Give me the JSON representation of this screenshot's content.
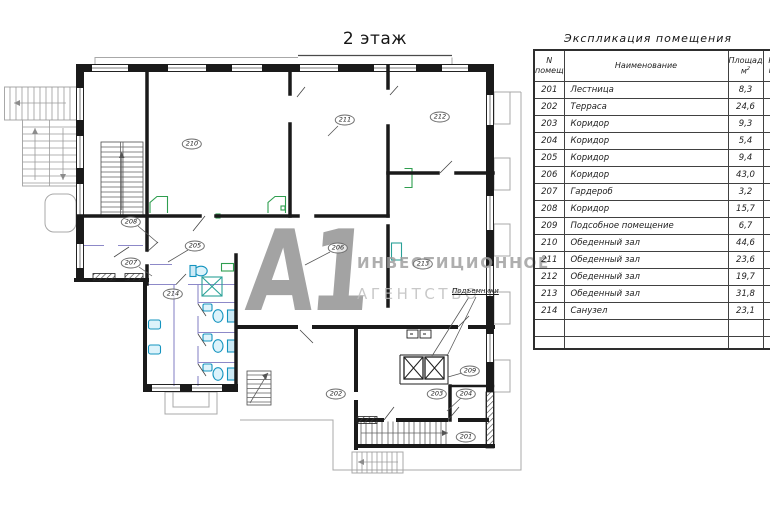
{
  "plan": {
    "title": "2 этаж",
    "lifts_label": "Подъемники",
    "room_labels": [
      {
        "num": "201",
        "x": 466,
        "y": 437
      },
      {
        "num": "202",
        "x": 336,
        "y": 394
      },
      {
        "num": "203",
        "x": 437,
        "y": 394
      },
      {
        "num": "204",
        "x": 466,
        "y": 394
      },
      {
        "num": "205",
        "x": 195,
        "y": 246
      },
      {
        "num": "206",
        "x": 338,
        "y": 248
      },
      {
        "num": "207",
        "x": 131,
        "y": 263
      },
      {
        "num": "208",
        "x": 131,
        "y": 222
      },
      {
        "num": "209",
        "x": 470,
        "y": 371
      },
      {
        "num": "210",
        "x": 192,
        "y": 144
      },
      {
        "num": "211",
        "x": 345,
        "y": 120
      },
      {
        "num": "212",
        "x": 440,
        "y": 117
      },
      {
        "num": "213",
        "x": 423,
        "y": 264
      },
      {
        "num": "214",
        "x": 173,
        "y": 294
      }
    ]
  },
  "watermark": {
    "logo": "А1",
    "line1": "ИНВЕСТИЦИОННОЕ",
    "line2": "АГЕНТСТВО"
  },
  "table": {
    "title": "Экспликация помещения",
    "header": {
      "num_l1": "N",
      "num_l2": "помещ.",
      "name": "Наименование",
      "area_l1": "Площадь,",
      "area_l2": "м",
      "area_sup": "2",
      "clipped_l1": "К",
      "clipped_l2": "п"
    },
    "rows": [
      {
        "num": "201",
        "name": "Лестница",
        "area": "8,3"
      },
      {
        "num": "202",
        "name": "Терраса",
        "area": "24,6"
      },
      {
        "num": "203",
        "name": "Коридор",
        "area": "9,3"
      },
      {
        "num": "204",
        "name": "Коридор",
        "area": "5,4"
      },
      {
        "num": "205",
        "name": "Коридор",
        "area": "9,4"
      },
      {
        "num": "206",
        "name": "Коридор",
        "area": "43,0"
      },
      {
        "num": "207",
        "name": "Гардероб",
        "area": "3,2"
      },
      {
        "num": "208",
        "name": "Коридор",
        "area": "15,7"
      },
      {
        "num": "209",
        "name": "Подсобное помещение",
        "area": "6,7"
      },
      {
        "num": "210",
        "name": "Обеденный зал",
        "area": "44,6"
      },
      {
        "num": "211",
        "name": "Обеденный зал",
        "area": "23,6"
      },
      {
        "num": "212",
        "name": "Обеденный зал",
        "area": "19,7"
      },
      {
        "num": "213",
        "name": "Обеденный зал",
        "area": "31,8"
      },
      {
        "num": "214",
        "name": "Санузел",
        "area": "23,1"
      }
    ],
    "empty_rows": 2
  },
  "colors": {
    "wall": "#1a1a1a",
    "fixture_cyan": "#1594bf",
    "partition_purple": "#8d89c8",
    "accent_green": "#2f9e4f",
    "accent_teal": "#2aa198",
    "watermark_gray": "#9d9d9d"
  }
}
